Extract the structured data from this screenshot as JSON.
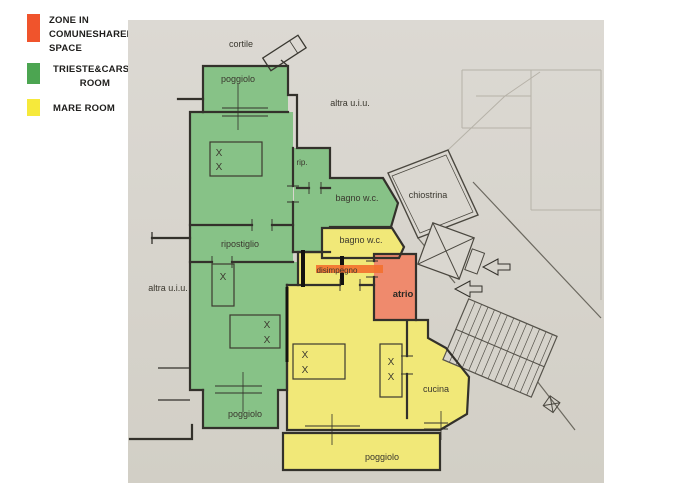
{
  "legend": {
    "items": [
      {
        "color": "#f0542c",
        "lines": [
          "ZONE IN",
          "COMUNESHARED",
          "SPACE"
        ]
      },
      {
        "color": "#4ca551",
        "lines": [
          "TRIESTE&CARSO",
          "ROOM"
        ]
      },
      {
        "color": "#f6e93b",
        "lines": [
          "MARE ROOM"
        ]
      }
    ]
  },
  "plan": {
    "bed_mark": "X",
    "labels": {
      "cortile": "cortile",
      "poggiolo_top": "poggiolo",
      "altra_uiu_top": "altra u.i.u.",
      "rip": "rip.",
      "bagno_green": "bagno w.c.",
      "chiostrina": "chiostrina",
      "ripostiglio": "ripostiglio",
      "bagno_yellow": "bagno w.c.",
      "disimpegno": "disimpegno",
      "atrio": "atrio",
      "altra_uiu_left": "altra u.i.u.",
      "cucina": "cucina",
      "poggiolo_bottom_left": "poggiolo",
      "poggiolo_bottom_center": "poggiolo"
    },
    "colors": {
      "shared_zone_fill": "#ef8a6d",
      "shared_strip": "#f3702e",
      "trieste_carso_fill": "#87c287",
      "mare_fill": "#f1e878",
      "paper": "#d8d5ce",
      "walls": "#33312b"
    }
  }
}
